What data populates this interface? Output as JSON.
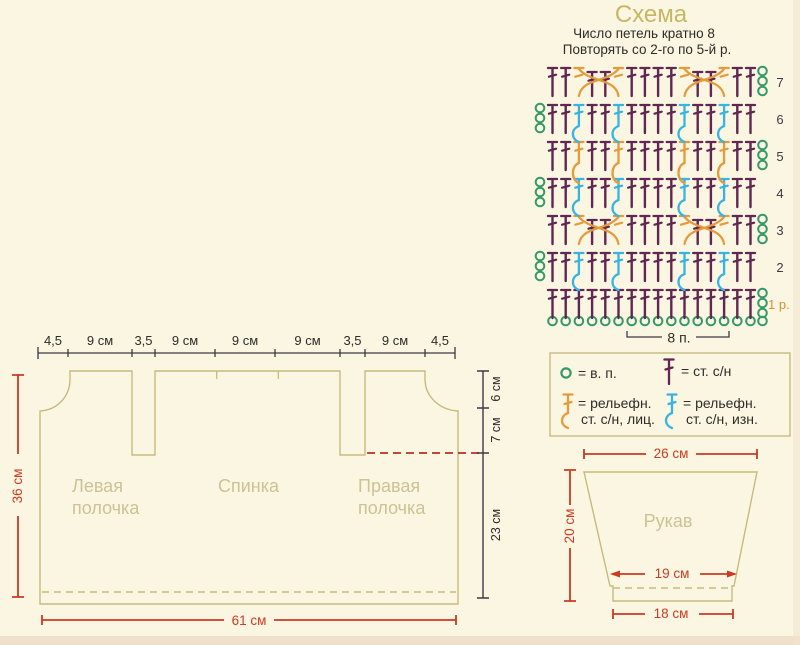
{
  "colors": {
    "bg": "#fbf6e1",
    "tan_outline": "#c6bb7e",
    "tan_text": "#cdc295",
    "title_olive": "#c6b765",
    "dark": "#3c3947",
    "text_dark": "#2e2c2a",
    "red": "#cb3a22",
    "red_dash": "#b53226",
    "chain_green": "#35996b",
    "dc_purple": "#5f2751",
    "relief_cyan": "#37b3e4",
    "relief_orange": "#e59a3b",
    "row_one_orange": "#df8c2e",
    "edge_pink": "#eddbc6"
  },
  "header": {
    "title": "Схема",
    "line1": "Число петель кратно 8",
    "line2": "Повторять со 2-го по 5-й р."
  },
  "chart": {
    "bracket_label": "8 п.",
    "layout": {
      "x0": 552.5,
      "dx": 13.2,
      "cols": 16,
      "ybase": 321,
      "pitch": 37,
      "stem": 28,
      "turnR": 762.5,
      "turnL": 540
    },
    "rows": [
      {
        "n": 1,
        "label": "1 р.",
        "turn": "right"
      },
      {
        "n": 2,
        "label": "2",
        "turn": "left",
        "back": [
          3,
          6,
          11,
          14
        ]
      },
      {
        "n": 3,
        "label": "3",
        "turn": "right",
        "cross": [
          3,
          11
        ]
      },
      {
        "n": 4,
        "label": "4",
        "turn": "left",
        "back": [
          3,
          6,
          11,
          14
        ]
      },
      {
        "n": 5,
        "label": "5",
        "turn": "right",
        "front": [
          3,
          6,
          11,
          14
        ]
      },
      {
        "n": 6,
        "label": "6",
        "turn": "left",
        "back": [
          3,
          6,
          11,
          14
        ]
      },
      {
        "n": 7,
        "label": "7",
        "turn": "right",
        "cross": [
          3,
          11
        ]
      }
    ]
  },
  "legend": {
    "ch": "= в. п.",
    "dc": "= ст. с/н",
    "rf1": "= рельефн.",
    "rf2": "ст. с/н, лиц.",
    "rb1": "= рельефн.",
    "rb2": "ст. с/н, изн."
  },
  "garment": {
    "top_measures": [
      "4,5",
      "9 см",
      "3,5",
      "9 см",
      "9 см",
      "9 см",
      "3,5",
      "9 см",
      "4,5"
    ],
    "left_measure": "36 см",
    "bottom_measure": "61 см",
    "right_measures": [
      "6 см",
      "7 см",
      "23 см"
    ],
    "pieces": {
      "left1": "Левая",
      "left2": "полочка",
      "back": "Спинка",
      "right1": "Правая",
      "right2": "полочка"
    }
  },
  "sleeve": {
    "label": "Рукав",
    "top": "26 см",
    "side": "20 см",
    "inner": "19 см",
    "bottom": "18 см"
  }
}
